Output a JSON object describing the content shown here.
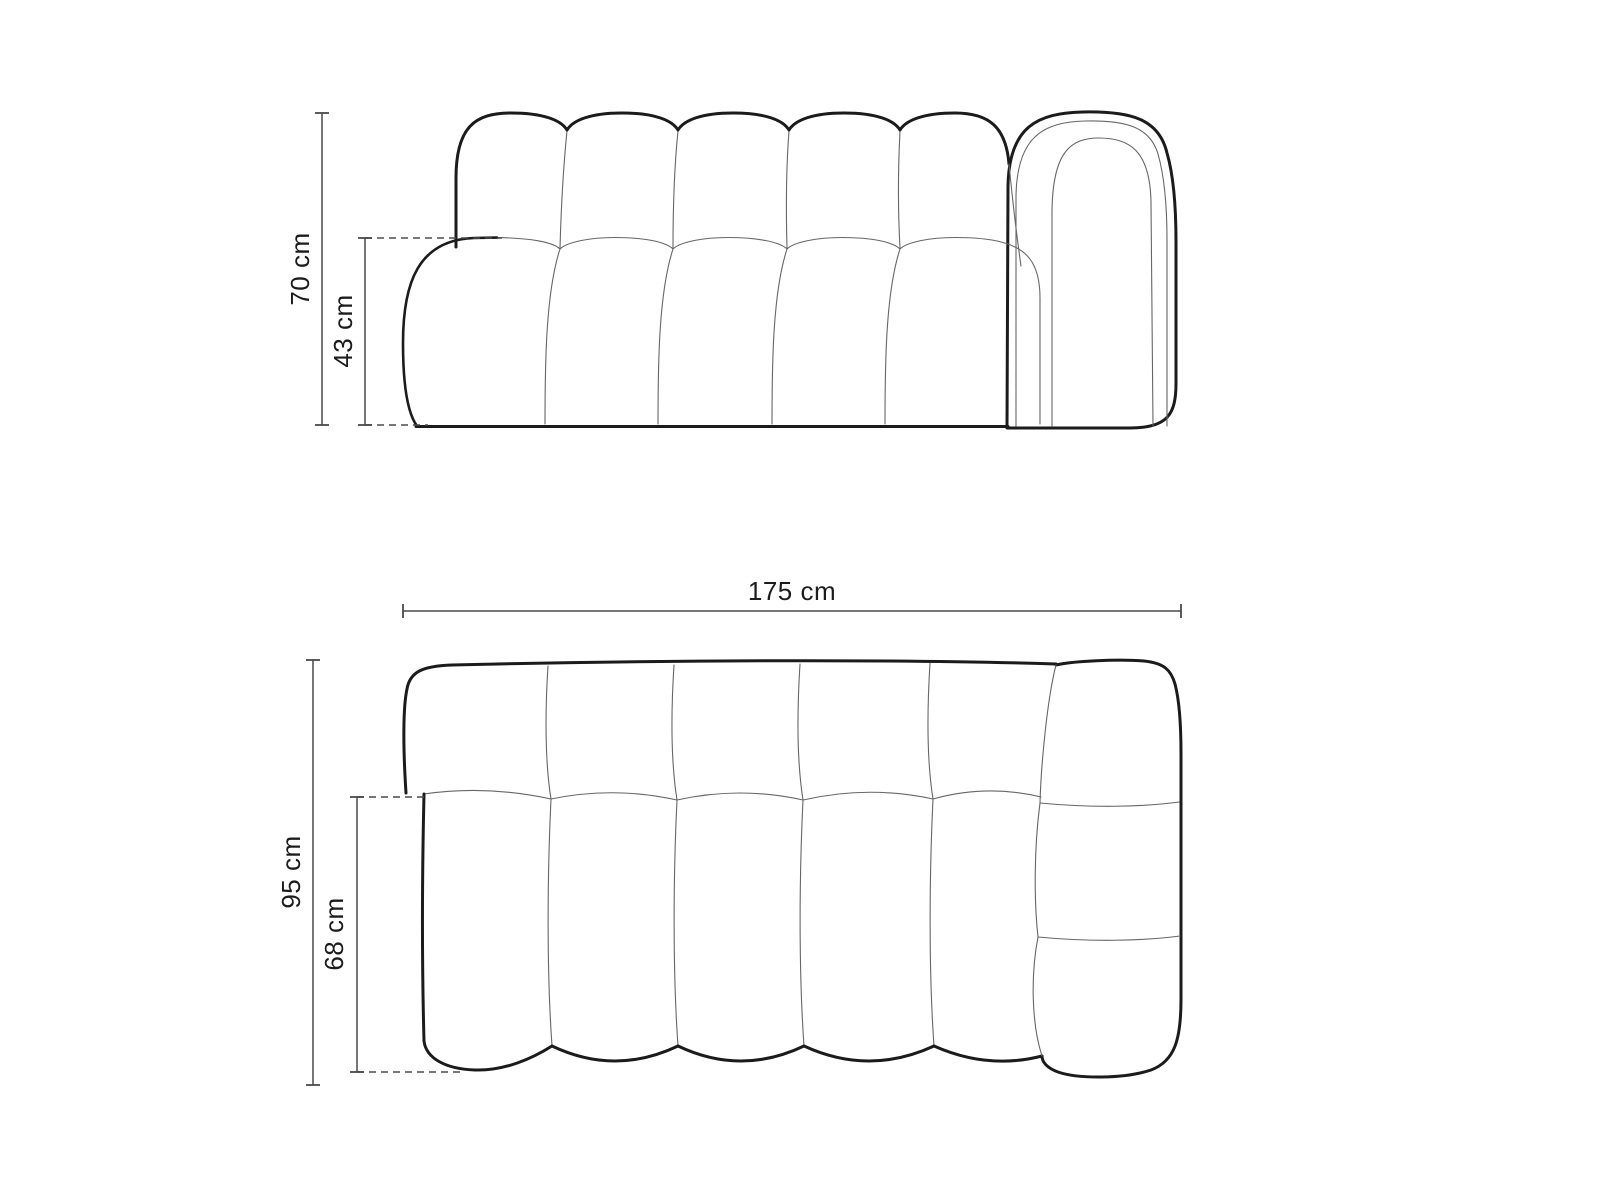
{
  "colors": {
    "background": "#ffffff",
    "outline": "#1b1b1b",
    "seam": "#666666",
    "dimension_line": "#4a4a4a",
    "label_text": "#1c1c1c"
  },
  "front_view": {
    "height_label": "70 cm",
    "seat_height_label": "43 cm"
  },
  "top_view": {
    "width_label": "175 cm",
    "depth_label": "95 cm",
    "seat_depth_label": "68 cm"
  }
}
